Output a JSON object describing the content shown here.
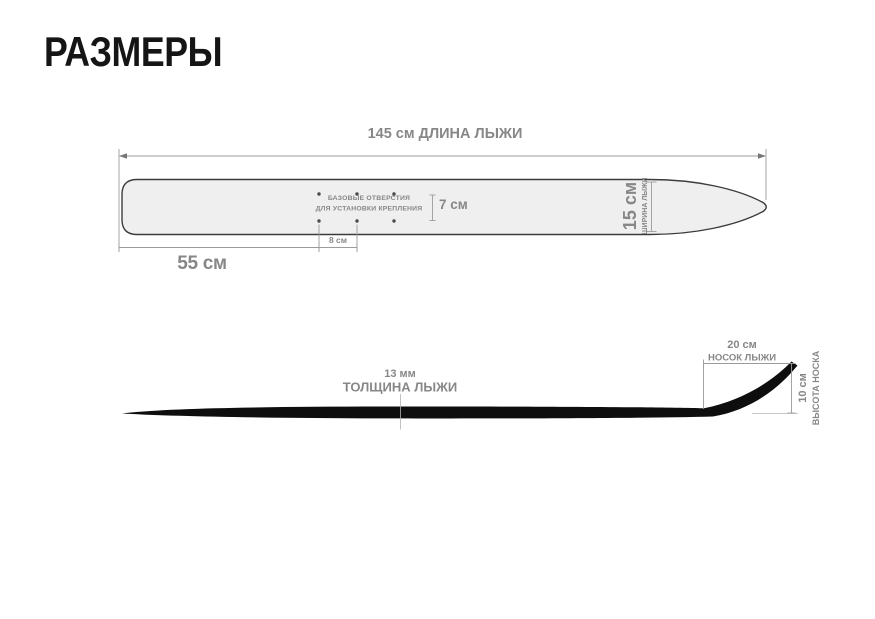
{
  "title": "РАЗМЕРЫ",
  "top_view": {
    "length": "145 см  ДЛИНА ЛЫЖИ",
    "tail_section": "55 см",
    "hole_spacing": "8 см",
    "hole_row_gap": "7 см",
    "width_value": "15 см",
    "width_label": "ШИРИНА ЛЫЖИ",
    "holes_note_1": "БАЗОВЫЕ ОТВЕРСТИЯ",
    "holes_note_2": "ДЛЯ УСТАНОВКИ КРЕПЛЕНИЯ"
  },
  "side_view": {
    "thickness_value": "13 мм",
    "thickness_label": "ТОЛЩИНА ЛЫЖИ",
    "tip_length_value": "20 см",
    "tip_length_label": "НОСОК ЛЫЖИ",
    "tip_height_value": "10 см",
    "tip_height_label": "ВЫСОТА НОСКА"
  },
  "colors": {
    "text_gray": "#878787",
    "line_gray": "#9b9b9b",
    "ski_top_fill": "#efefef",
    "ski_top_outline": "#3c3c3c",
    "ski_side_fill": "#0e0e0e",
    "title_color": "#151515"
  }
}
